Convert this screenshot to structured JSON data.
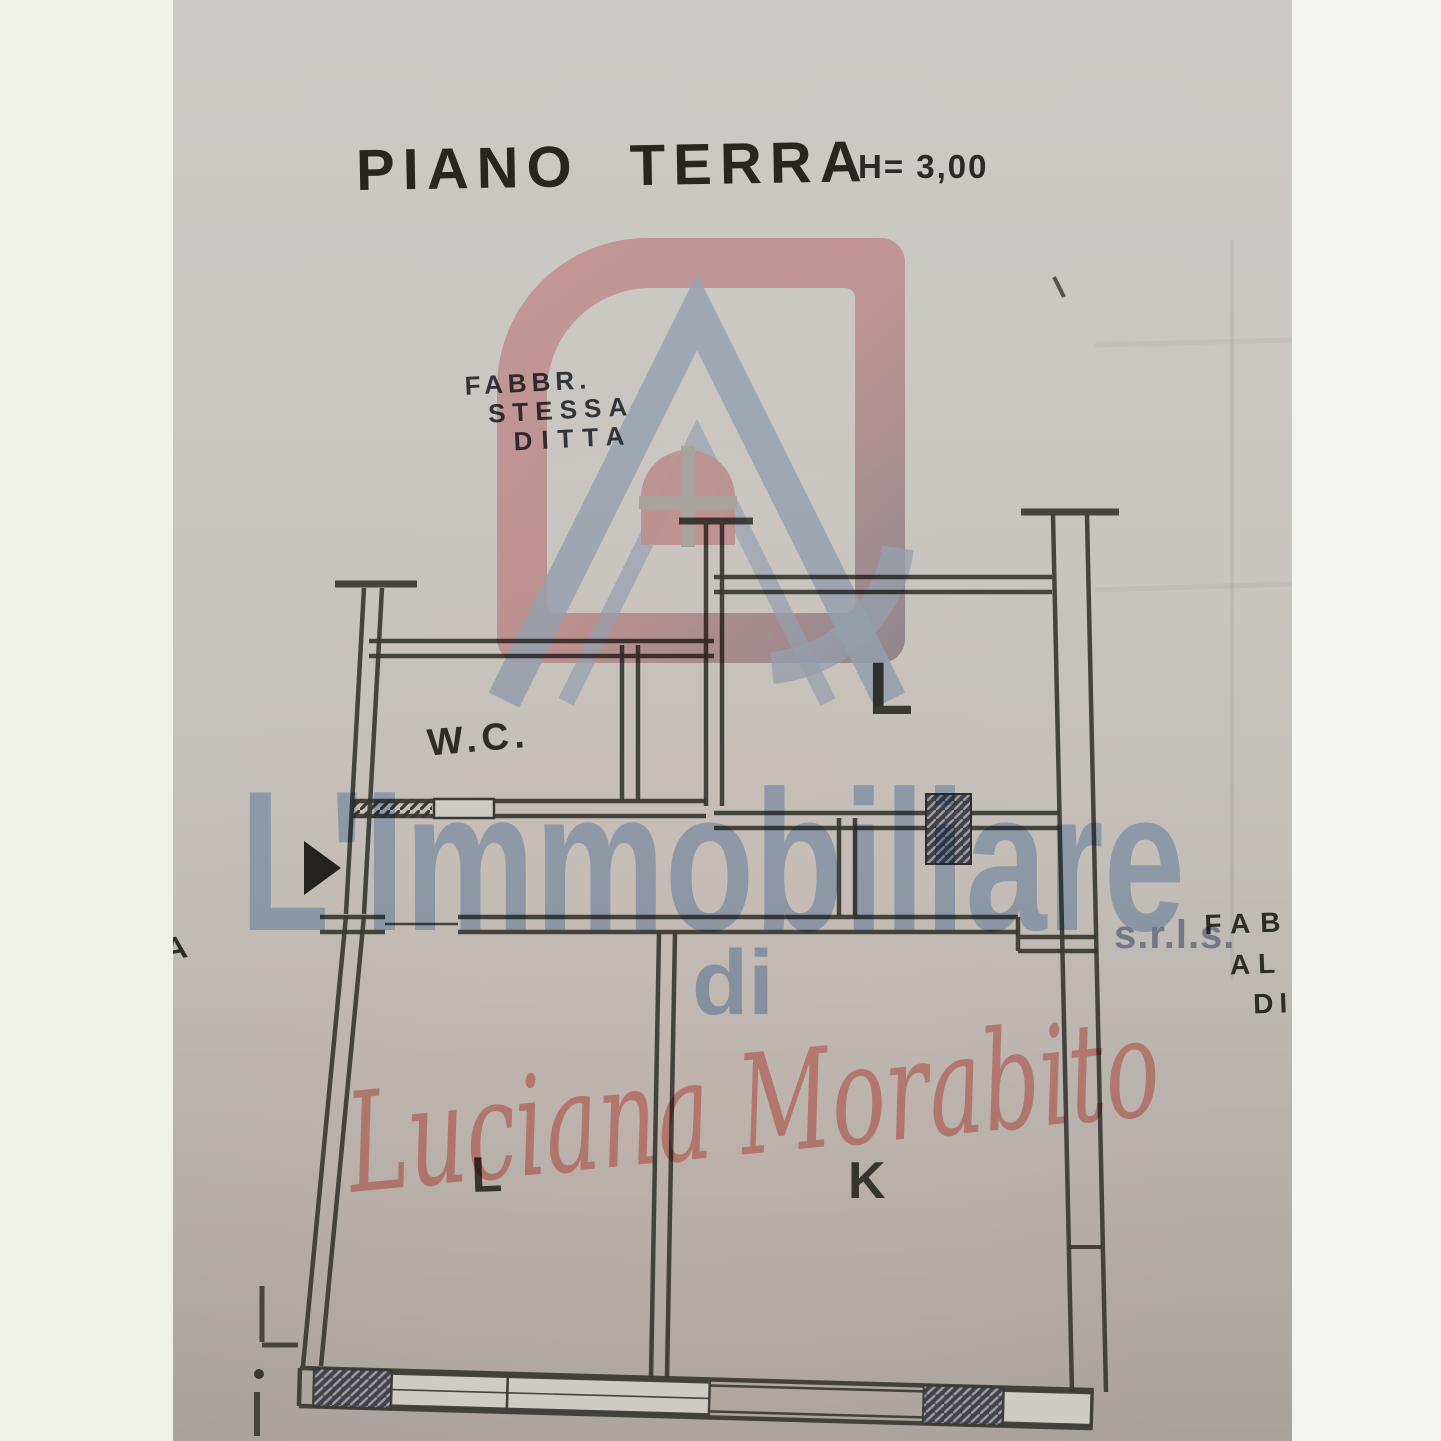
{
  "page": {
    "background_left": "#eef0e9",
    "background_right": "#f4f5f1"
  },
  "photo": {
    "description": "pencil floor plan photographed on gray paper",
    "paper_top": "#cccac6",
    "paper_bottom": "#a8a29c",
    "ink": "#3a3833"
  },
  "plan": {
    "title": "PIANO TERRA",
    "height_note": "H= 3,00",
    "rooms": {
      "wc": "W.C.",
      "upper_living": "L",
      "lower_living": "L",
      "kitchen": "K"
    },
    "note_same_building": {
      "line1": "FABBR.",
      "line2": "STESSA",
      "line3": "DITTA"
    },
    "note_adjacent_building": {
      "line1": "FAB",
      "line2": "AL",
      "line3": "DI"
    },
    "left_edge_fragment": "A"
  },
  "watermark": {
    "brand": "L'Immobiliare",
    "legal_suffix": "s.r.l.s.",
    "connector": "di",
    "owner_name": "Luciana Morabito",
    "brand_color": "#a9c3e3",
    "legal_color": "#8d9bbb",
    "script_color": "#ef9f9a",
    "logo_pink": "#f2b0b2",
    "logo_blue": "#aec3e2"
  }
}
